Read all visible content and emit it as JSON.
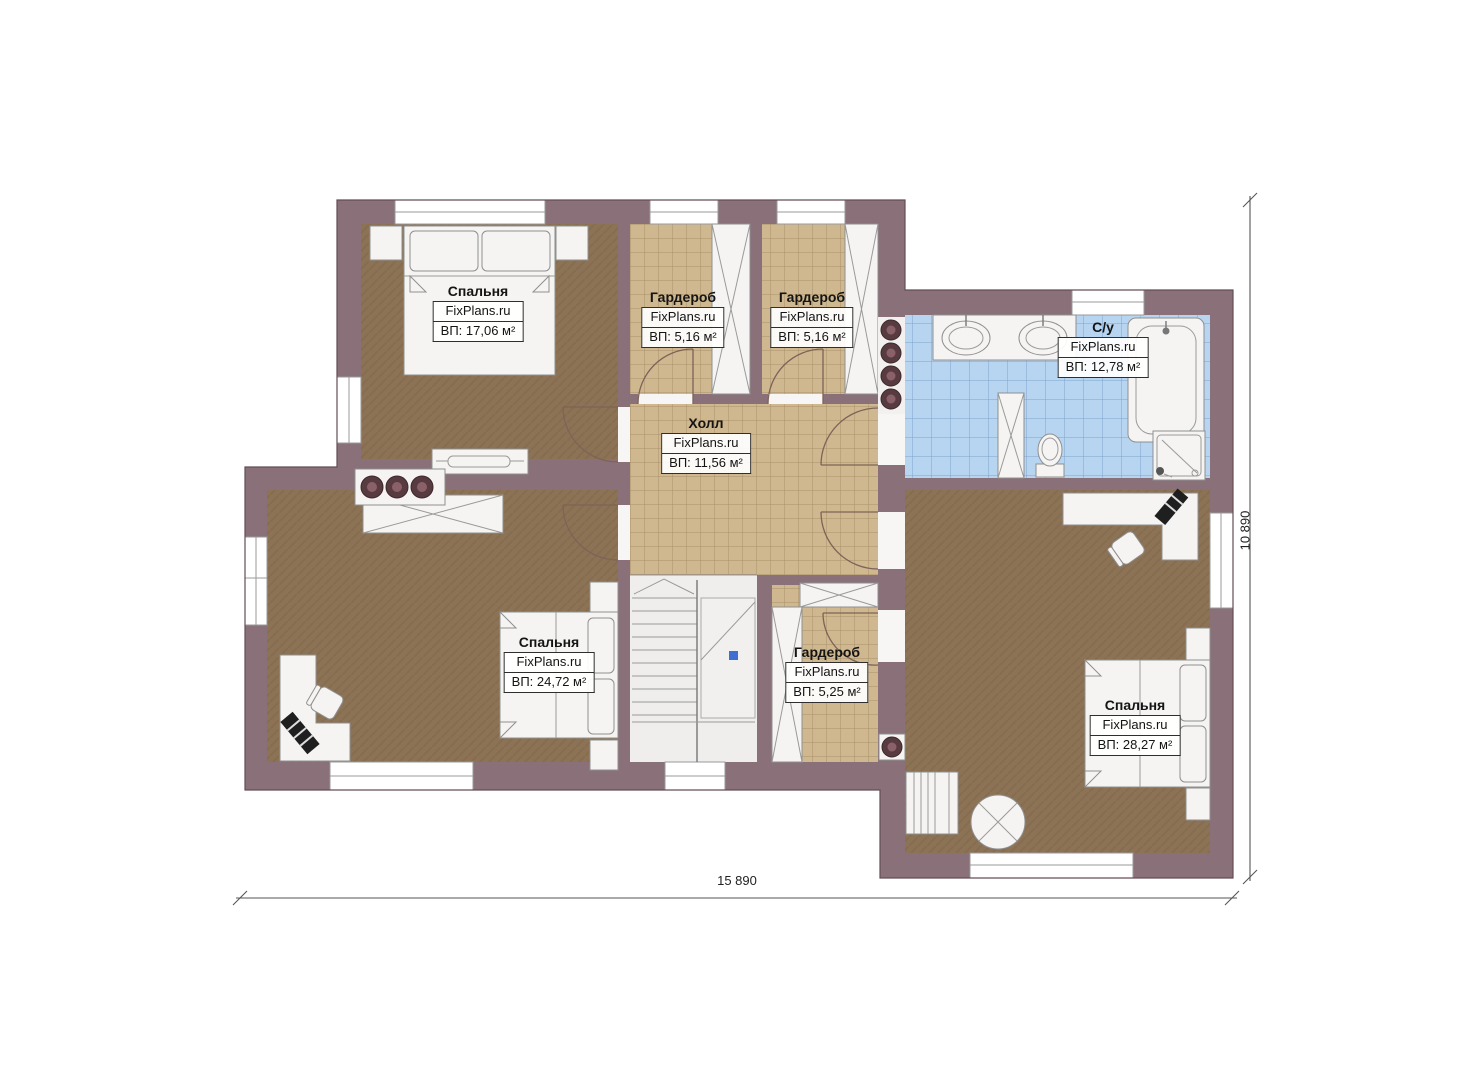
{
  "rooms": [
    {
      "id": "bedroom-top-left",
      "name": "Спальня",
      "watermark": "FixPlans.ru",
      "area": "ВП: 17,06 м²"
    },
    {
      "id": "wardrobe-1",
      "name": "Гардероб",
      "watermark": "FixPlans.ru",
      "area": "ВП: 5,16 м²"
    },
    {
      "id": "wardrobe-2",
      "name": "Гардероб",
      "watermark": "FixPlans.ru",
      "area": "ВП: 5,16 м²"
    },
    {
      "id": "bathroom",
      "name": "С/у",
      "watermark": "FixPlans.ru",
      "area": "ВП: 12,78 м²"
    },
    {
      "id": "hall",
      "name": "Холл",
      "watermark": "FixPlans.ru",
      "area": "ВП: 11,56 м²"
    },
    {
      "id": "bedroom-bottom-left",
      "name": "Спальня",
      "watermark": "FixPlans.ru",
      "area": "ВП: 24,72 м²"
    },
    {
      "id": "wardrobe-3",
      "name": "Гардероб",
      "watermark": "FixPlans.ru",
      "area": "ВП: 5,25 м²"
    },
    {
      "id": "bedroom-bottom-right",
      "name": "Спальня",
      "watermark": "FixPlans.ru",
      "area": "ВП: 28,27 м²"
    }
  ],
  "dimensions": {
    "width": "15 890",
    "height": "10 890"
  },
  "colors": {
    "wall": "#8a7078",
    "bedroom_floor": "#8d7355",
    "tile_floor": "#cfb88f",
    "bath_floor": "#b7d5f0"
  }
}
